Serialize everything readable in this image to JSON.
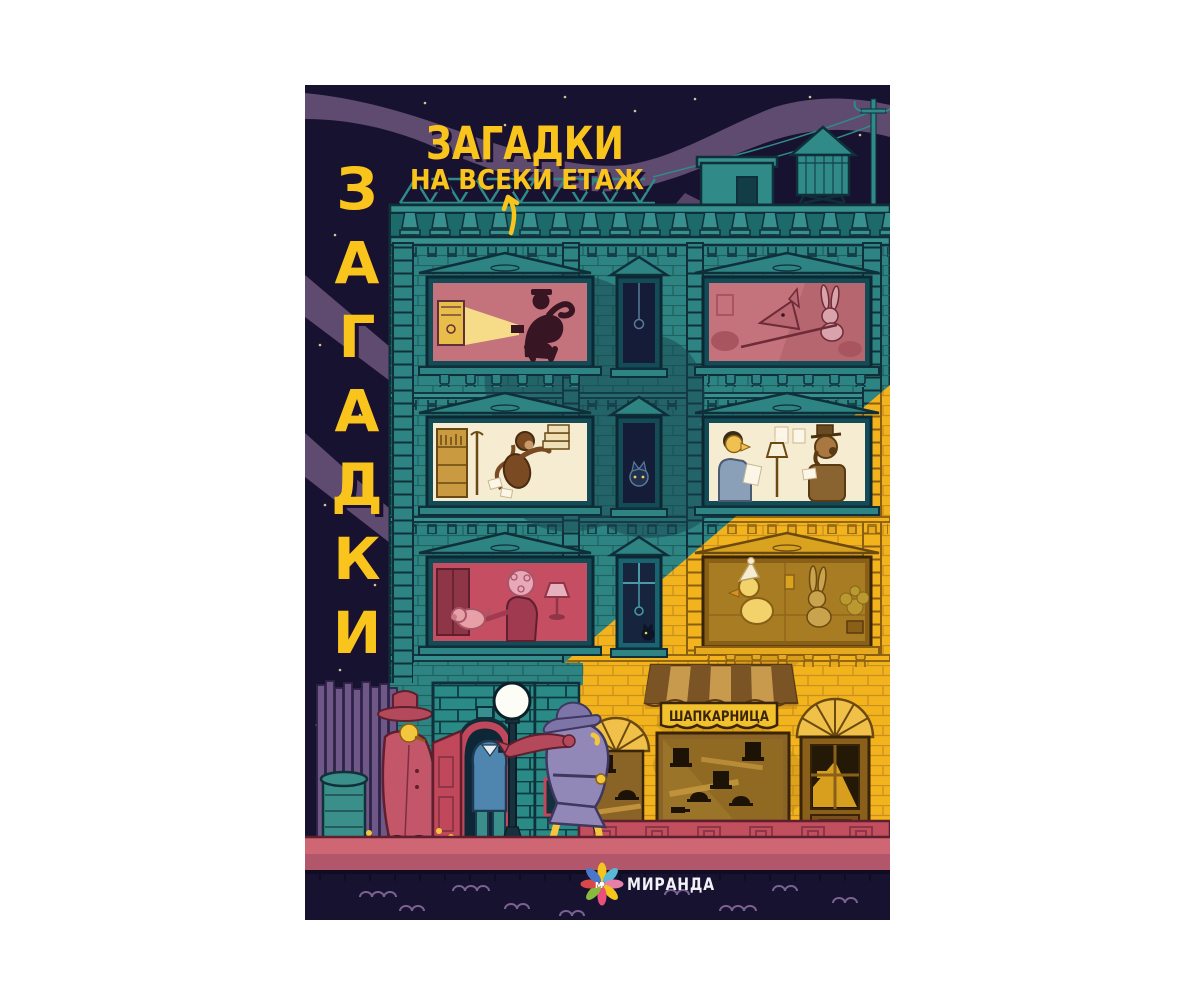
{
  "page": {
    "background_color": "#ffffff",
    "description": "book cover on white background"
  },
  "cover": {
    "vertical_title": {
      "word": "ЗАГАДКИ",
      "letters": [
        "З",
        "А",
        "Г",
        "А",
        "Д",
        "К",
        "И"
      ],
      "color": "#f9c51c"
    },
    "roof_sign": {
      "line1": "ЗАГАДКИ",
      "line2": "НА ВСЕКИ ЕТАЖ",
      "color": "#f9c51c"
    },
    "hat_shop_sign": "ШАПКАРНИЦА",
    "publisher": {
      "name": "МИРАНДА",
      "logo_initial": "М"
    },
    "palette": {
      "night_sky": "#171230",
      "cloud_purple": "#5f4a70",
      "building_teal": "#2e8482",
      "beam_yellow": "#f2b31d",
      "shadow_teal": "#17444f",
      "window_pink": "#c4737c",
      "window_cream": "#f5ecd2",
      "window_red": "#c54e63",
      "window_amber": "#a87c22",
      "window_dark": "#141c38",
      "door_red": "#c0485a",
      "sidewalk_pink": "#cf6673",
      "awning_tan": "#c79a4e",
      "title_yellow": "#f9c51c"
    },
    "windows": [
      {
        "floor": "top",
        "position": "left",
        "scene": "burglar with flashlight cracking a safe",
        "interior": "pink"
      },
      {
        "floor": "top",
        "position": "middle",
        "scene": "dark window with hanging pendulum",
        "interior": "dark blue"
      },
      {
        "floor": "top",
        "position": "right",
        "scene": "fox and rabbit tussling",
        "interior": "pink"
      },
      {
        "floor": "middle",
        "position": "left",
        "scene": "monkey carrying a stack of books",
        "interior": "cream"
      },
      {
        "floor": "middle",
        "position": "middle",
        "scene": "cat looking out of dark window",
        "interior": "dark blue"
      },
      {
        "floor": "middle",
        "position": "right",
        "scene": "man reading and dog in hat at a desk",
        "interior": "cream"
      },
      {
        "floor": "lower",
        "position": "left",
        "scene": "woman and pig in red room",
        "interior": "red"
      },
      {
        "floor": "lower",
        "position": "middle",
        "scene": "cat and hanging ball in dark window",
        "interior": "dark blue"
      },
      {
        "floor": "lower",
        "position": "right",
        "scene": "duck in nightcap with rabbit",
        "interior": "amber lit by beam"
      }
    ],
    "street": {
      "characters": [
        "figure in red coat and hat leaning by fence",
        "figure in blue suit entering red doorway",
        "detective in purple trench coat with red scarf walking past lamppost"
      ],
      "props": [
        "wooden fence",
        "trash can",
        "street lamp with white globe",
        "hat shop display full of hats",
        "arched shop door",
        "water tower",
        "rooftop shed",
        "power pole"
      ]
    }
  }
}
